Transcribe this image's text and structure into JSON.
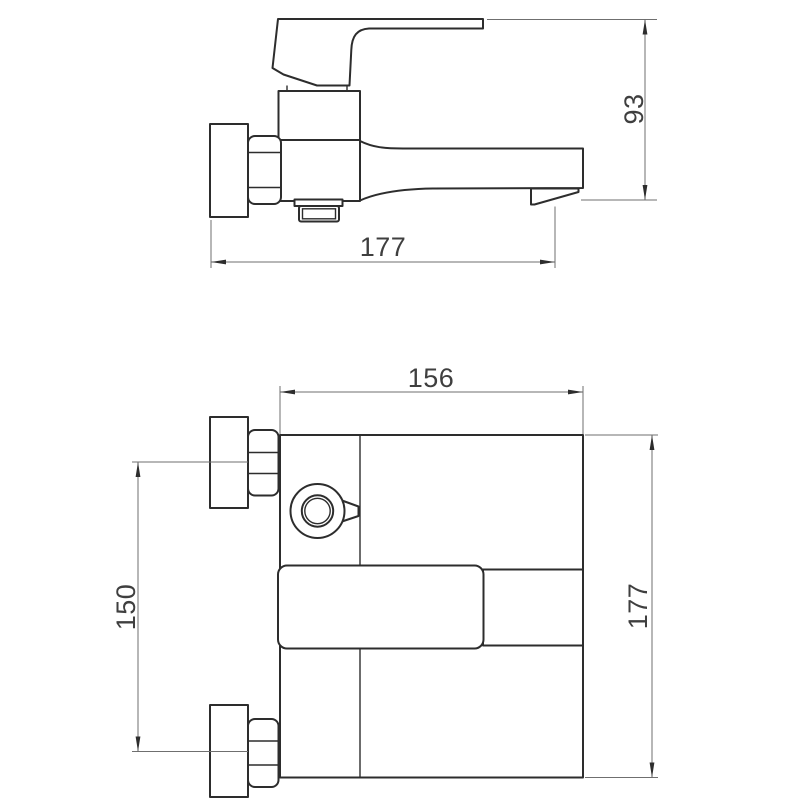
{
  "colors": {
    "background": "#ffffff",
    "object_line": "#2d2d2d",
    "dimension_line": "#6f6f6f",
    "label_text": "#3f3f3f"
  },
  "drawing": {
    "kind": "technical dimension drawing",
    "subject": "wall-mounted single-lever bath mixer faucet, two orthographic views"
  },
  "views": {
    "side": {
      "length_label": "177",
      "height_label": "93"
    },
    "front": {
      "width_label": "156",
      "spacing_label": "150",
      "height_label": "177"
    }
  }
}
